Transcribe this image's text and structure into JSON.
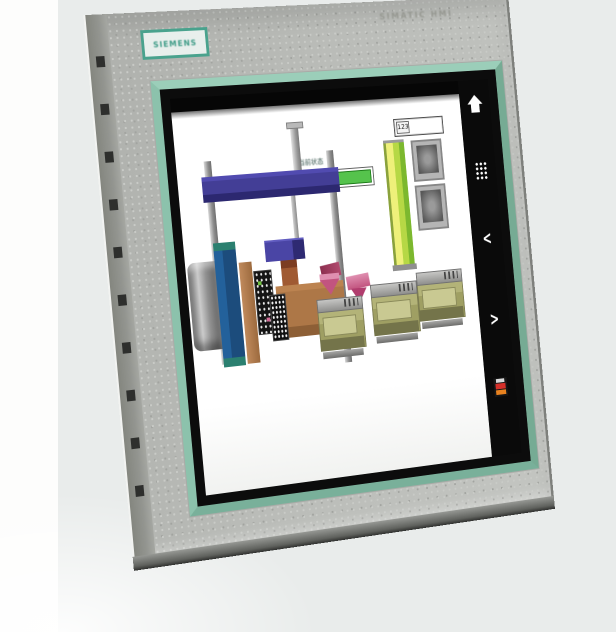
{
  "device": {
    "brand_logo": "SIEMENS",
    "model_label": "SIMATIC HMI"
  },
  "hmi_screen": {
    "status_label": "当前状态",
    "value_field": {
      "value": "123"
    },
    "nav": {
      "home_icon": "home",
      "keypad_icon": "numeric-keypad",
      "prev_label": "<",
      "next_label": ">",
      "alarm_icon": "alarm"
    },
    "graphics": {
      "conveyor": "conveyor-green",
      "gantry": "gantry-crane-blue",
      "press": "press-machine-blue-teal",
      "workbench": "workbench-brown",
      "hopper": "hopper-pink",
      "lift_column": "lift-column-yellow-green",
      "cabinets": "control-cabinets-gray",
      "process_units": "process-units-olive"
    },
    "colors": {
      "bezel_trim_green": "#8cc2ac",
      "sidebar_black": "#0a0a0a",
      "conveyor_green": "#45b33e",
      "column_yellow_green": "#c8e04a",
      "gantry_blue": "#433e96",
      "machine_blue": "#1d4e7c",
      "machine_teal": "#2b8070",
      "bench_brown": "#ad7747",
      "hopper_pink": "#c2547f",
      "unit_olive": "#a8a86a",
      "alarm_red": "#d5302a",
      "alarm_orange": "#e8821f"
    }
  }
}
